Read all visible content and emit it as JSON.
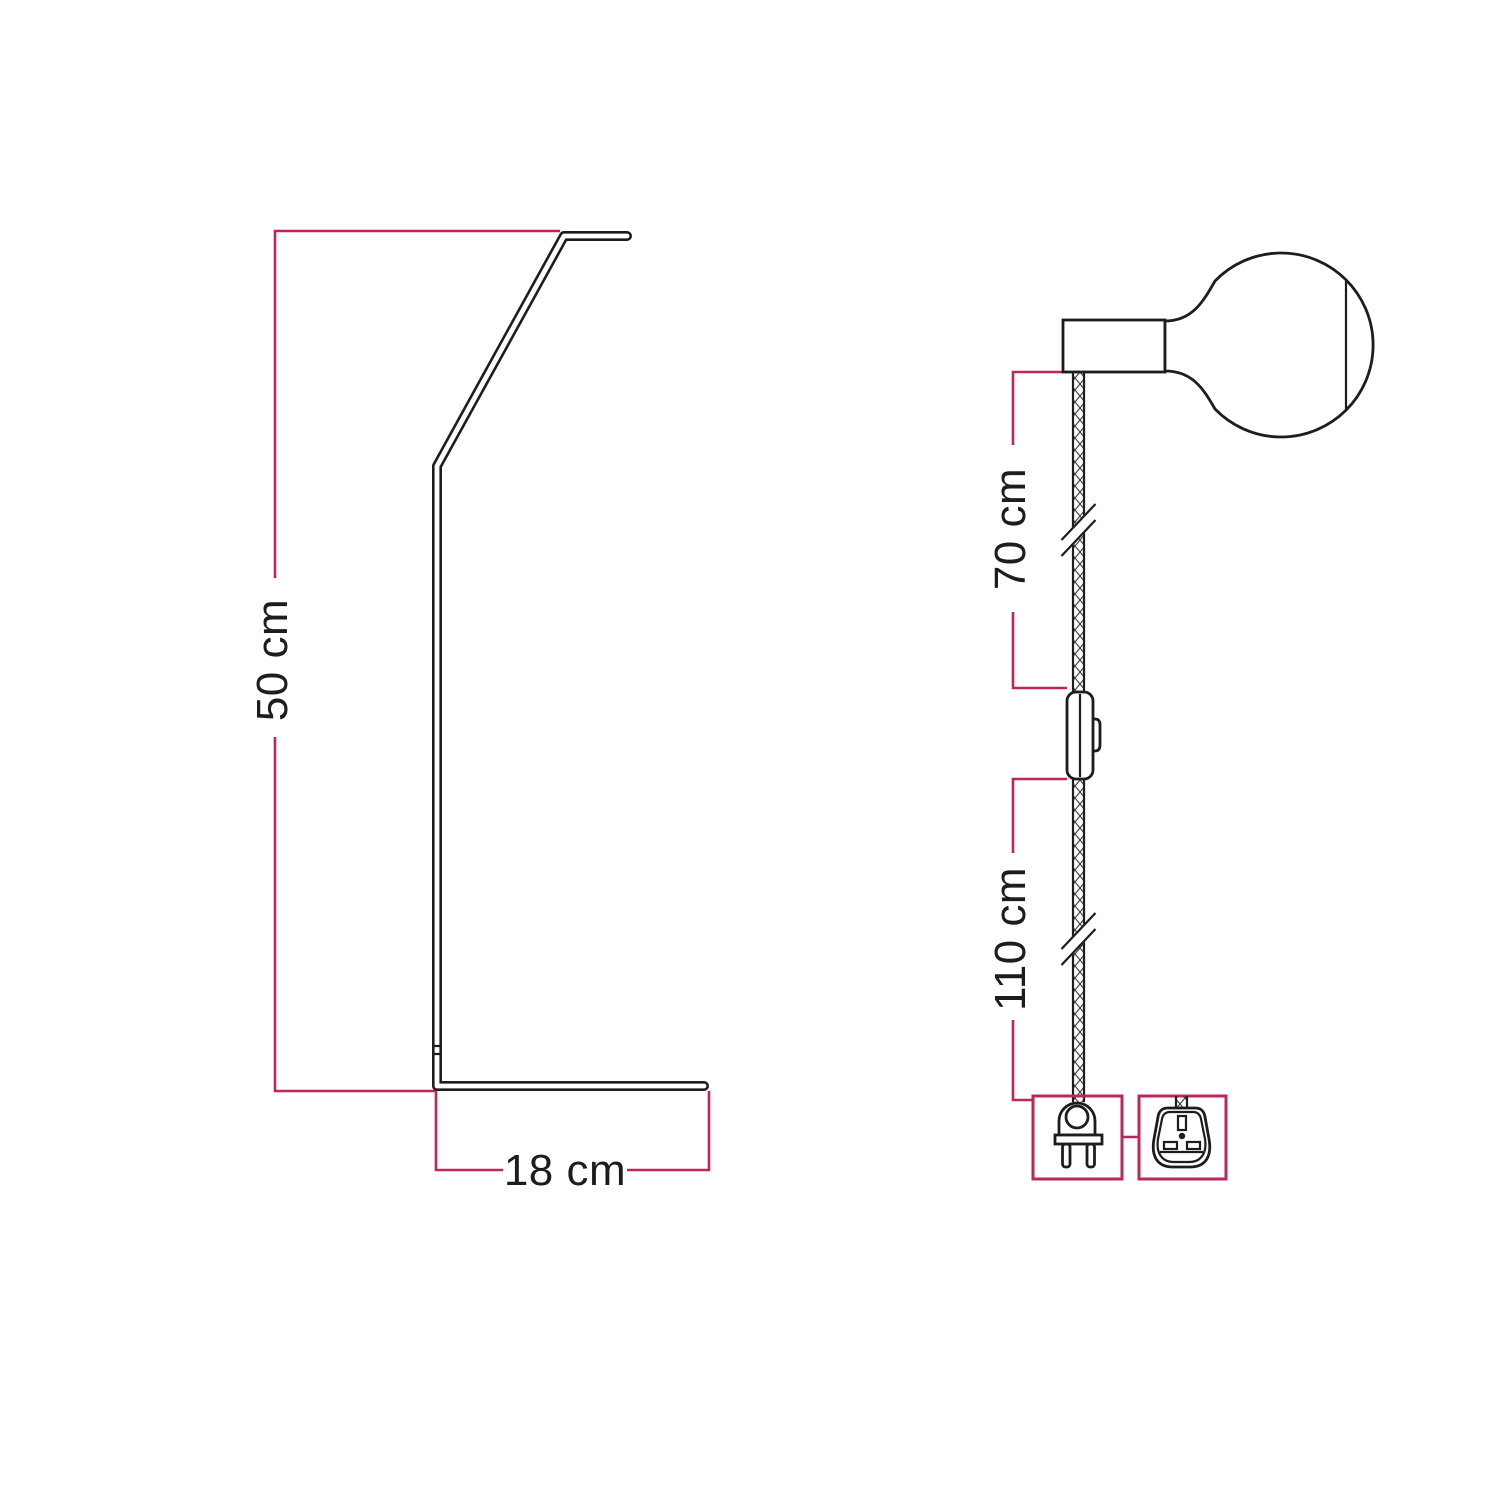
{
  "colors": {
    "background": "#ffffff",
    "outline": "#1d1d1b",
    "dimension": "#bd2758",
    "text": "#1d1d1b"
  },
  "stand_view": {
    "description": "bent metal stand side profile",
    "height_label": "50 cm",
    "base_label": "18 cm"
  },
  "cable_view": {
    "description": "pendant cord with lamp holder, bulb, switch and plug",
    "upper_label": "70 cm",
    "lower_label": "110 cm",
    "icons": [
      "lamp-holder",
      "globe-bulb",
      "braided-cable",
      "cable-break",
      "inline-switch",
      "euro-plug",
      "uk-plug-adapter"
    ]
  }
}
